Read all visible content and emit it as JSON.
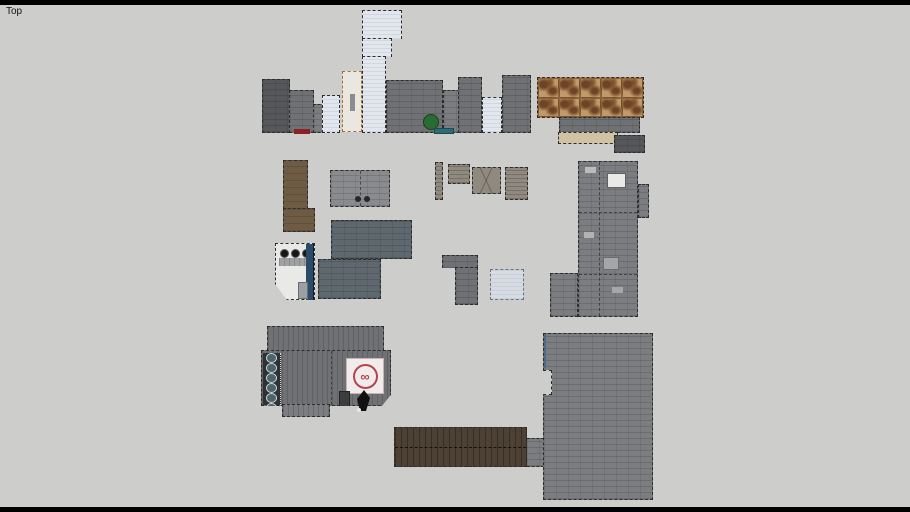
{
  "viewport": {
    "label": "Top"
  },
  "sign": {
    "symbol": "∞"
  },
  "colors": {
    "canvas_bg": "#cdcdcb",
    "frame_bar": "#000000",
    "roof_dark_gray": "#55575a",
    "roof_med": "#6f7175",
    "roof_gray": "#7b7d80",
    "roof_light": "#898b8e",
    "roof_white": "#e2e6ed",
    "roof_bluegray": "#5e686e",
    "brown_roof": "#6d5b44",
    "plank_brown": "#4c4134",
    "shed_tan": "#8f897f",
    "copper": "#c09a68",
    "copper_dark": "#6d4526",
    "tan_strip": "#cfc3a4",
    "sign_red": "#b5444e",
    "tree_green": "#2a6b35",
    "teal_awning": "#2e6b74",
    "drum_teal": "#4a666a",
    "stripe_blue": "#2b4b6b",
    "car_red": "#8b2025"
  }
}
